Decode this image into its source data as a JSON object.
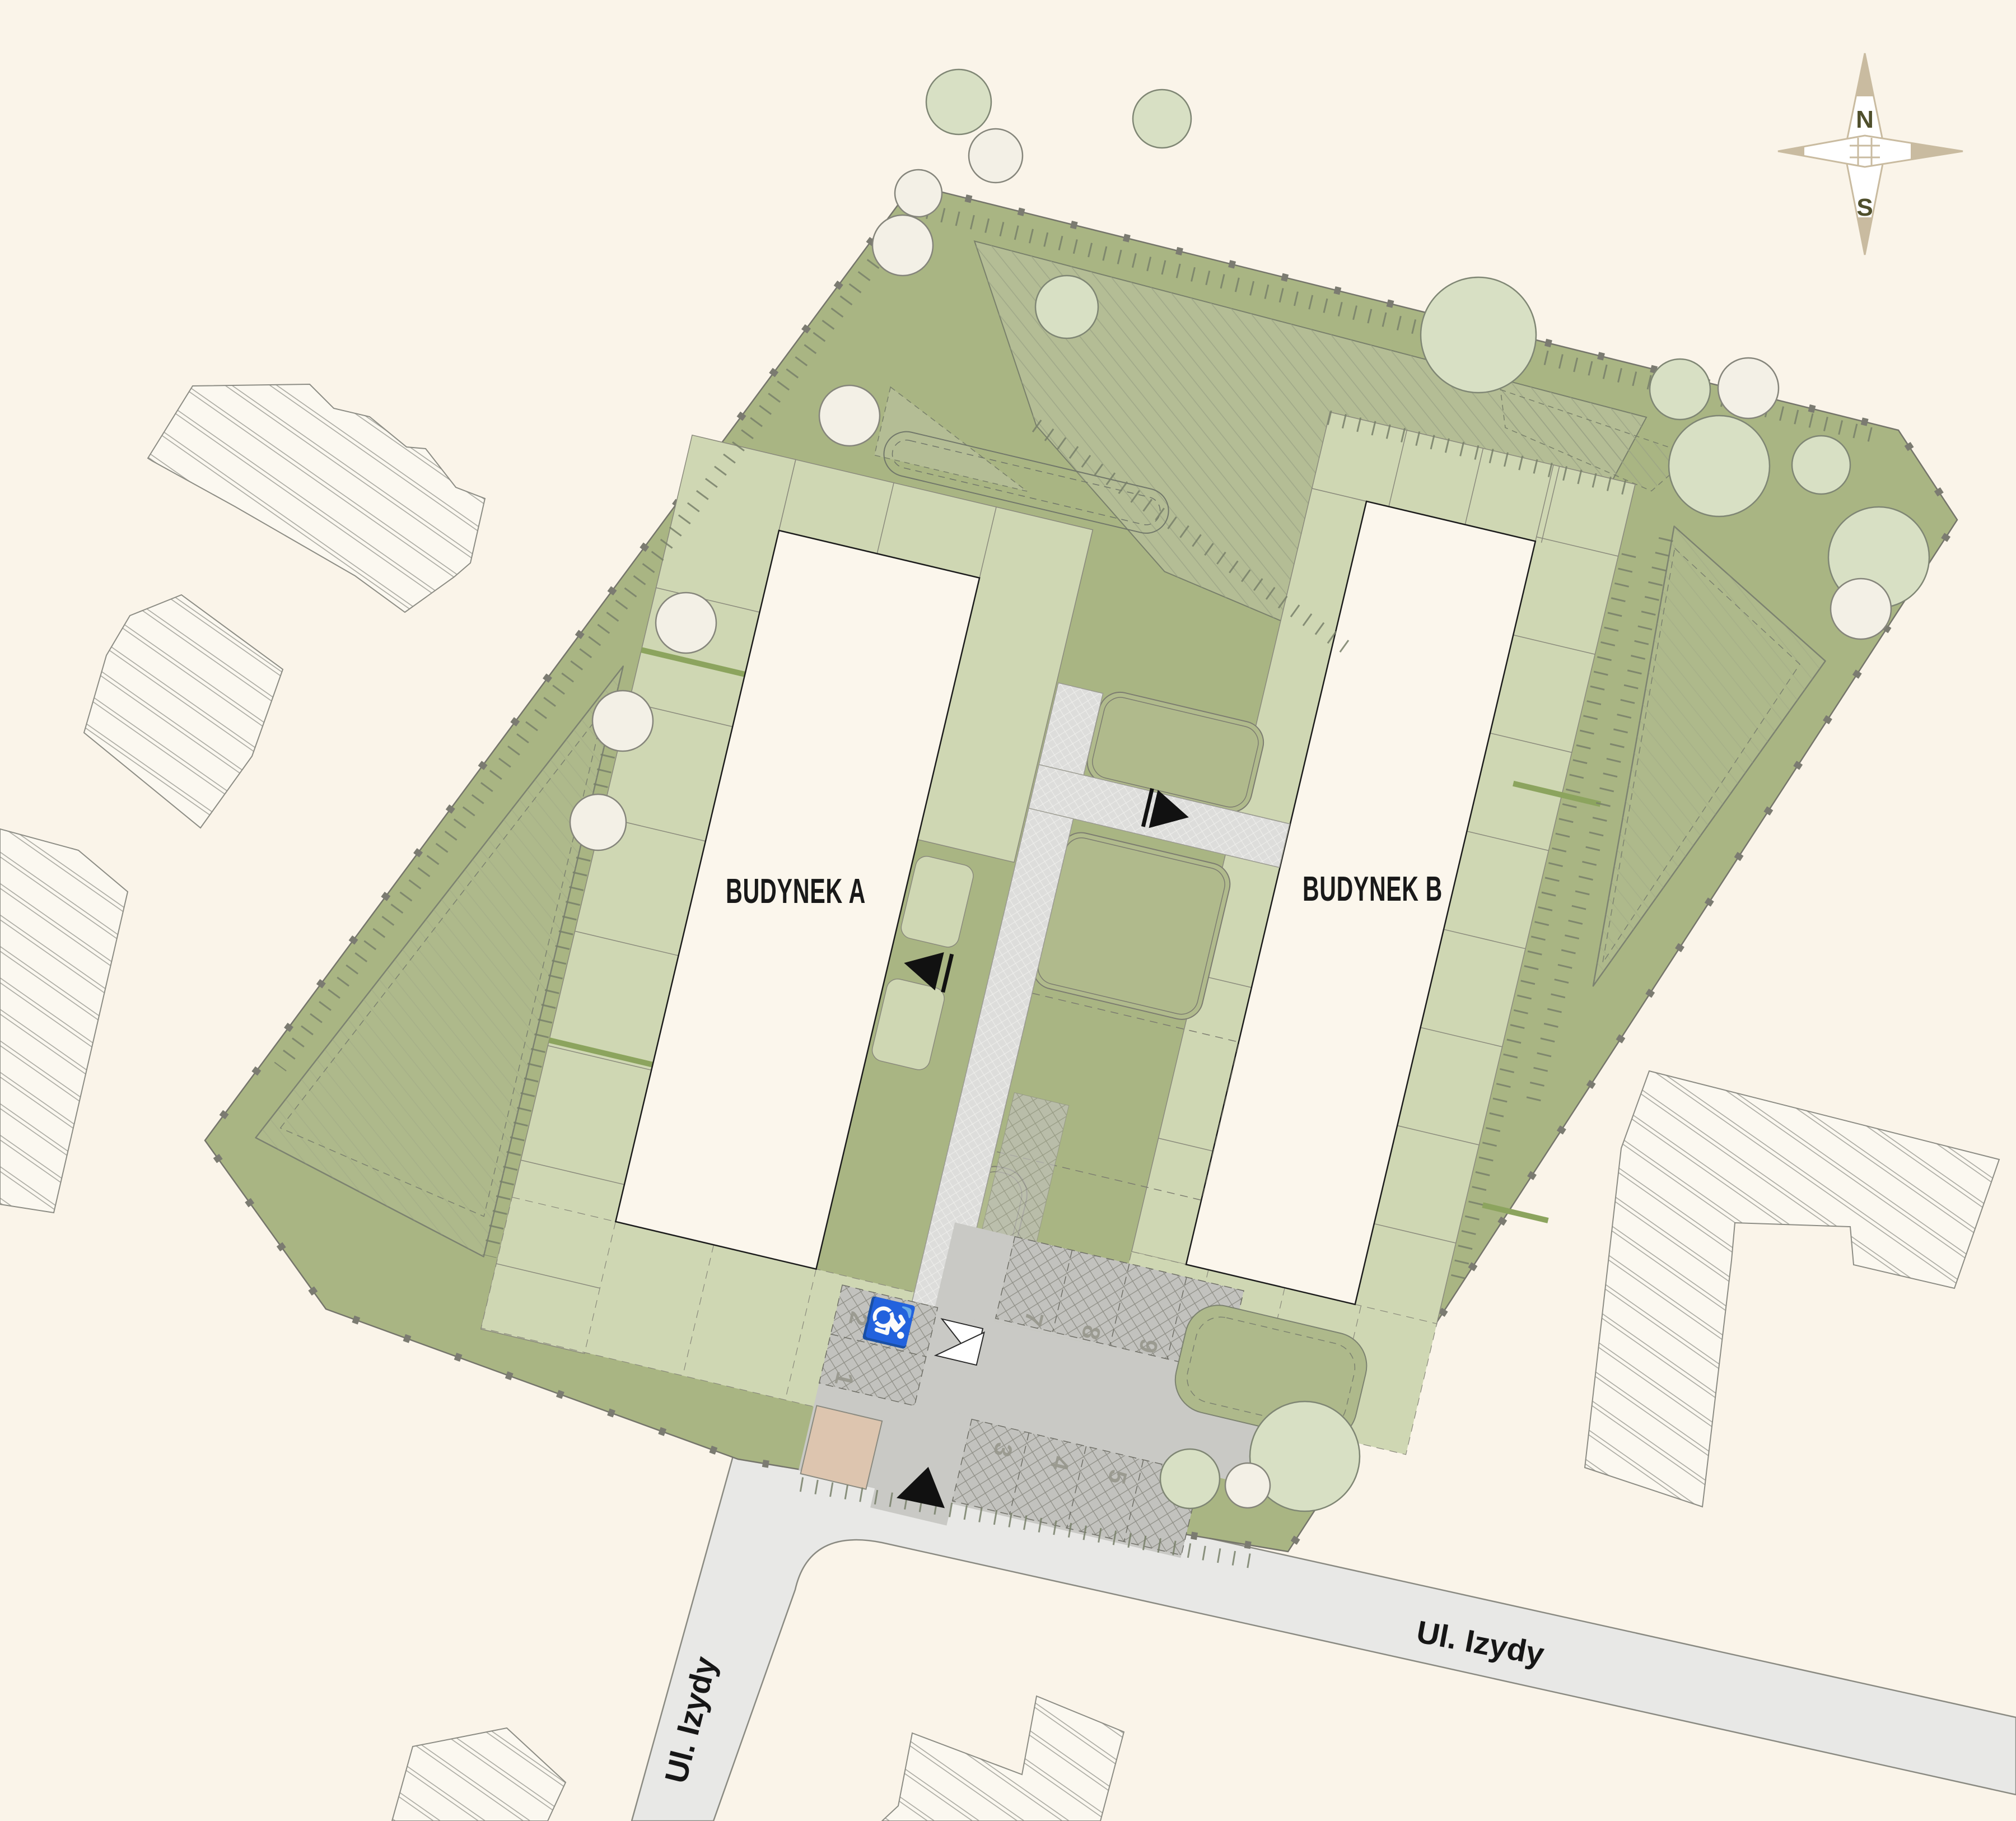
{
  "title": "Site plan — residential development",
  "buildings": [
    {
      "id": "A",
      "label": "BUDYNEK A"
    },
    {
      "id": "B",
      "label": "BUDYNEK B"
    }
  ],
  "streets": {
    "main_label": "Ul. Izydy",
    "side_label": "Ul. Izydy"
  },
  "compass": {
    "north": "N",
    "south": "S"
  },
  "parking": {
    "stall_numbers": [
      "1",
      "2",
      "3",
      "4",
      "5",
      "6",
      "7",
      "8",
      "9",
      "10"
    ],
    "disabled_symbol": "♿"
  },
  "icons": [
    "compass-rose-icon",
    "wheelchair-icon",
    "entrance-arrow-icon",
    "gate-icon",
    "tree-icon"
  ],
  "colors": {
    "background": "#faf4e9",
    "site_green": "#a9b583",
    "terrace_pale_green": "#cfd7b3",
    "hatched_lawn_green": "#b4bd95",
    "tree_green": "#d8e0c4",
    "tree_white": "#f3f0e6",
    "road_gray": "#e8e8e6",
    "driveway_gray": "#c9c9c5",
    "parking_stall_gray": "#c2c2be",
    "footpath_gray": "#dddddb",
    "bin_shelter_tan": "#ddc5af",
    "building_fill": "#fbf6ec",
    "compass_tan": "#c9bba0",
    "label_black": "#191919"
  }
}
